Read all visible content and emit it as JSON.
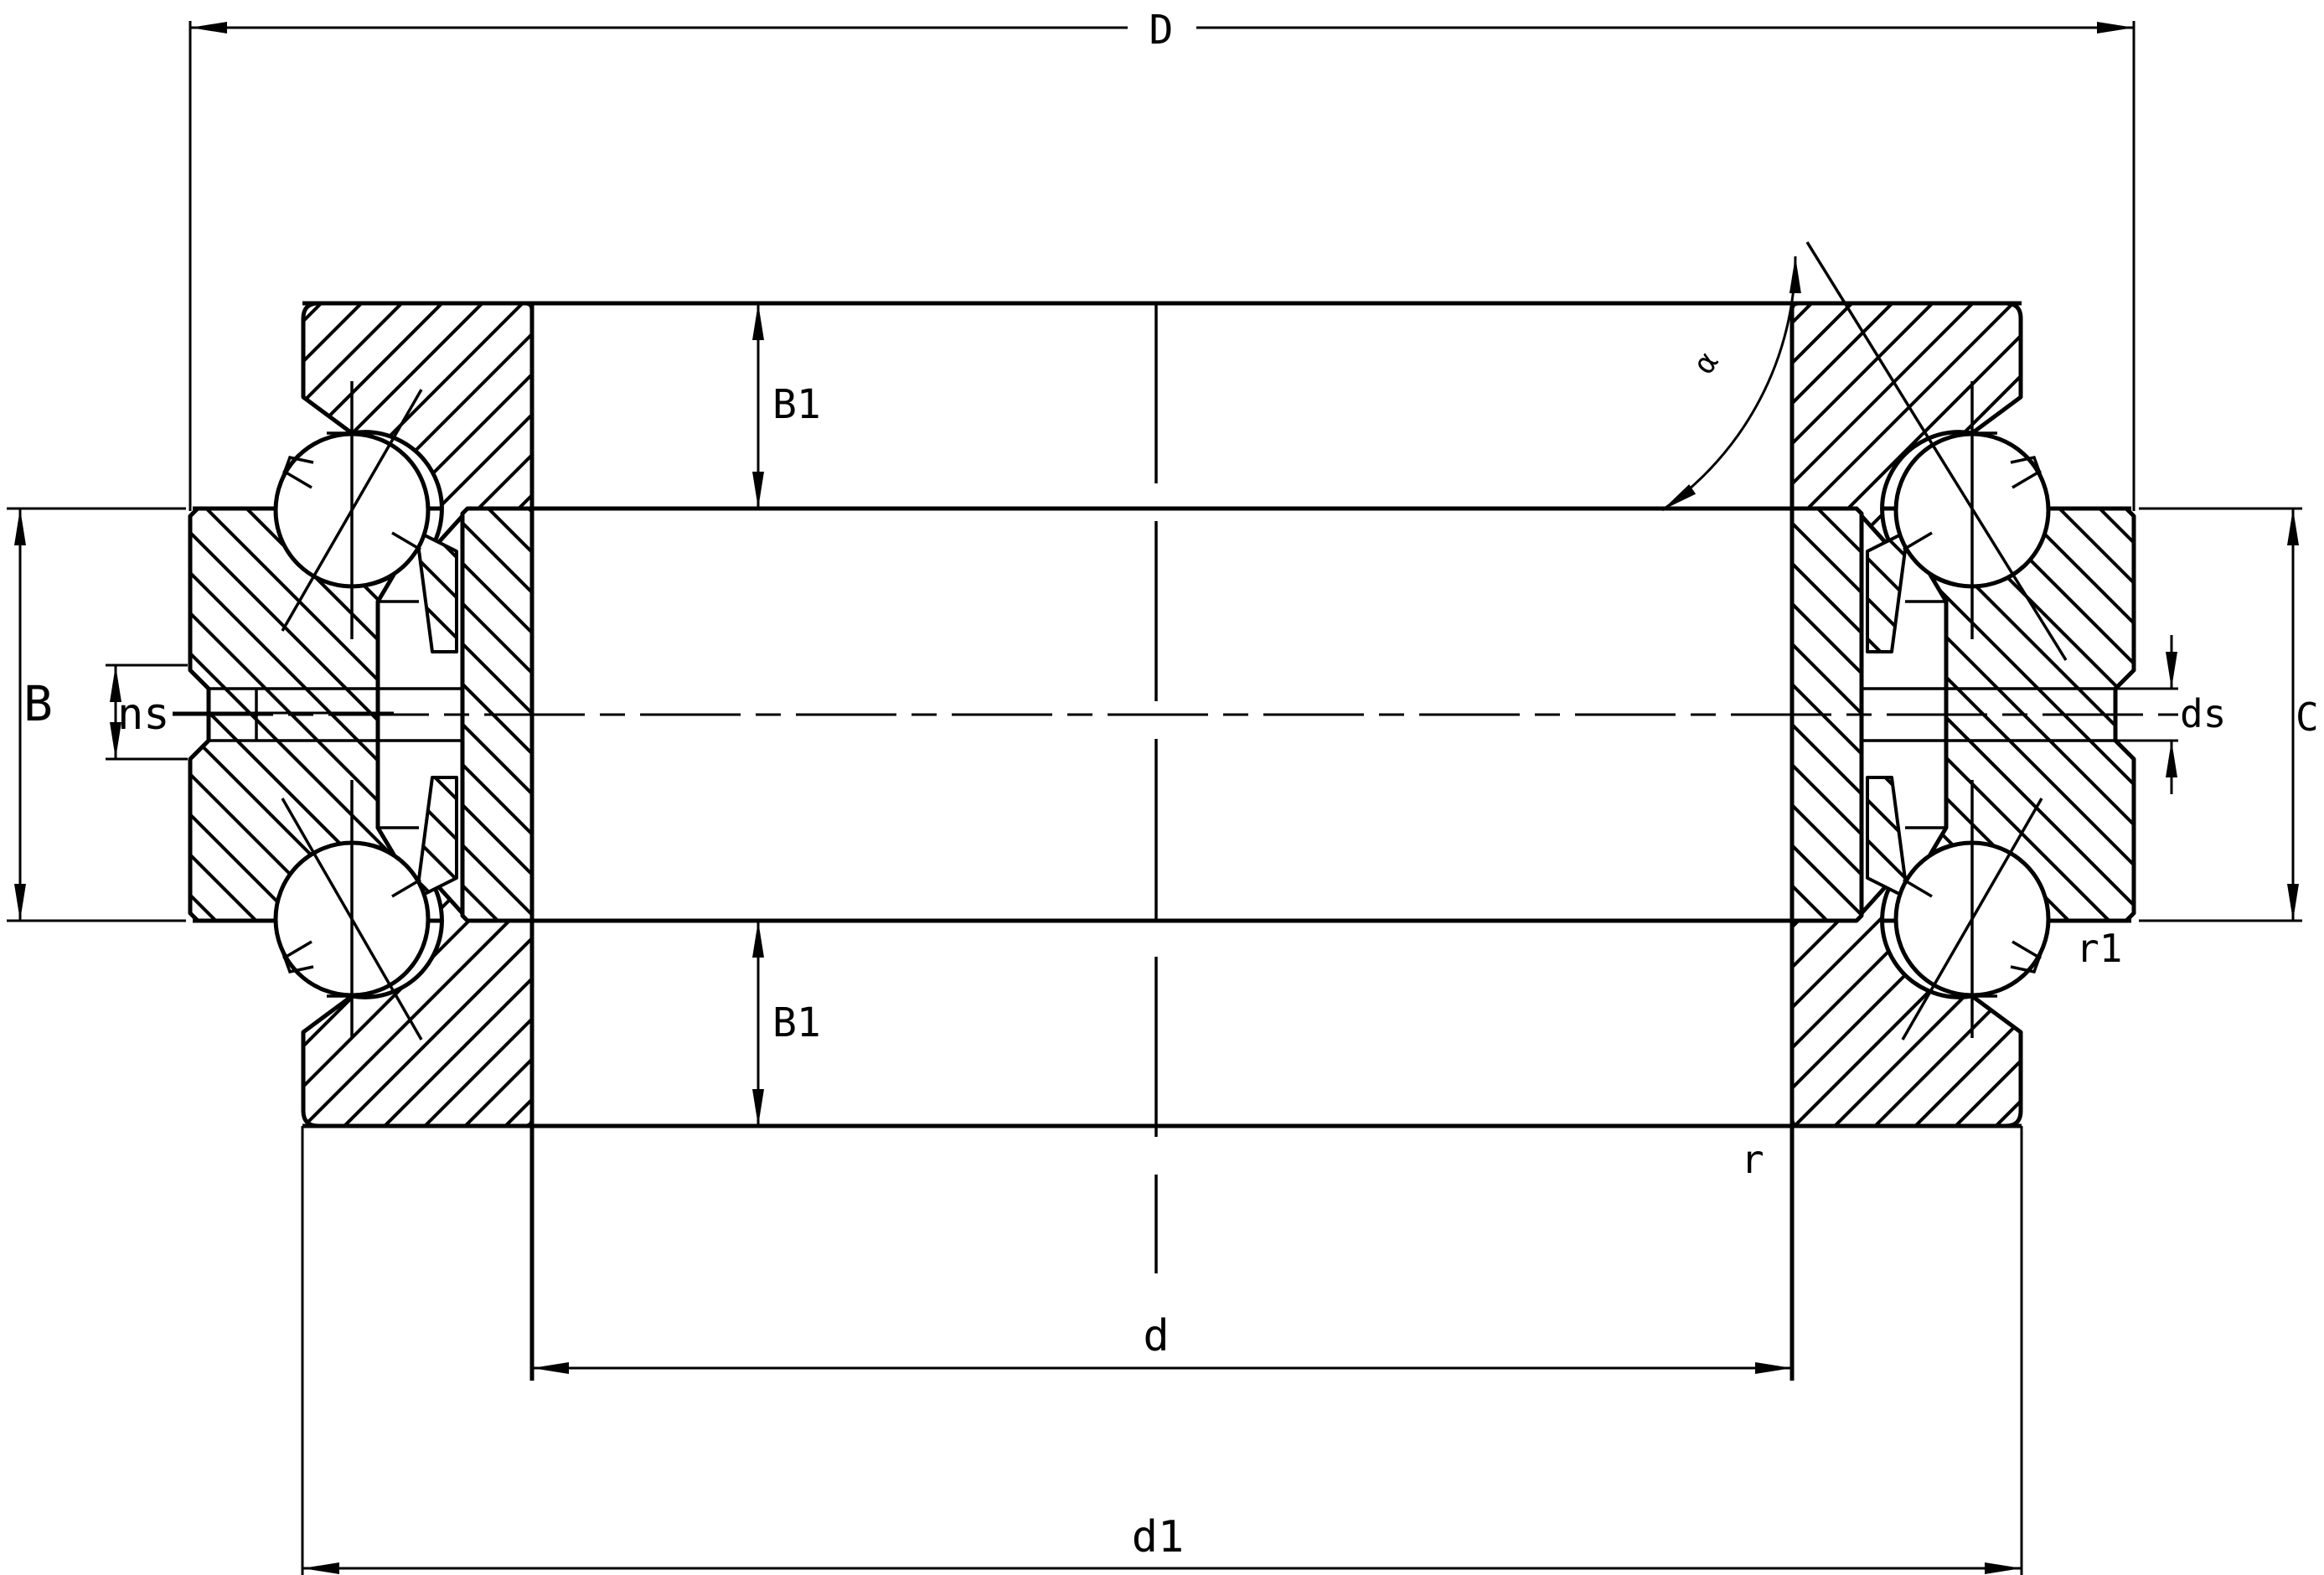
{
  "drawing": {
    "kind": "bearing-cross-section-technical-drawing",
    "colors": {
      "line": "#000000",
      "background": "#ffffff"
    },
    "labels": {
      "D": "D",
      "B1_top": "B1",
      "B1_bottom": "B1",
      "B": "B",
      "ns": "ns",
      "ds": "ds",
      "C": "C",
      "d": "d",
      "d1": "d1",
      "r": "r",
      "r1": "r1",
      "alpha": "α"
    }
  }
}
